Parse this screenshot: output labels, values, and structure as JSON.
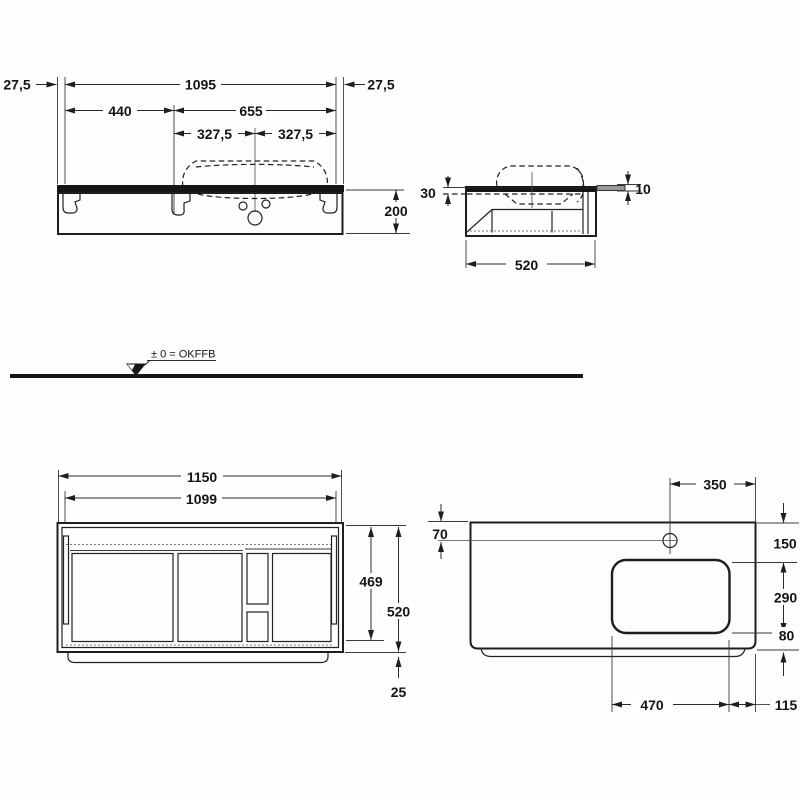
{
  "drawing": {
    "ground": {
      "level_label": "± 0 = OKFFB"
    },
    "front_view_top": {
      "left_overhang": "27,5",
      "cabinet_width": "1095",
      "right_overhang": "27,5",
      "left_section": "440",
      "basin_span": "655",
      "basin_half_left": "327,5",
      "basin_half_right": "327,5",
      "apron_height": "200"
    },
    "side_view": {
      "countertop_thickness": "30",
      "towel_rail_diameter": "10",
      "depth": "520"
    },
    "front_view_bottom": {
      "countertop_width": "1150",
      "cabinet_width": "1099",
      "drawer_front_height": "469",
      "total_height": "520",
      "plinth_height": "25"
    },
    "plan_view": {
      "tap_hole_from_right": "350",
      "tap_hole_from_back": "70",
      "edge_to_cutout": "150",
      "cutout_depth": "290",
      "front_margin": "80",
      "cutout_width": "470",
      "right_margin": "115"
    }
  }
}
